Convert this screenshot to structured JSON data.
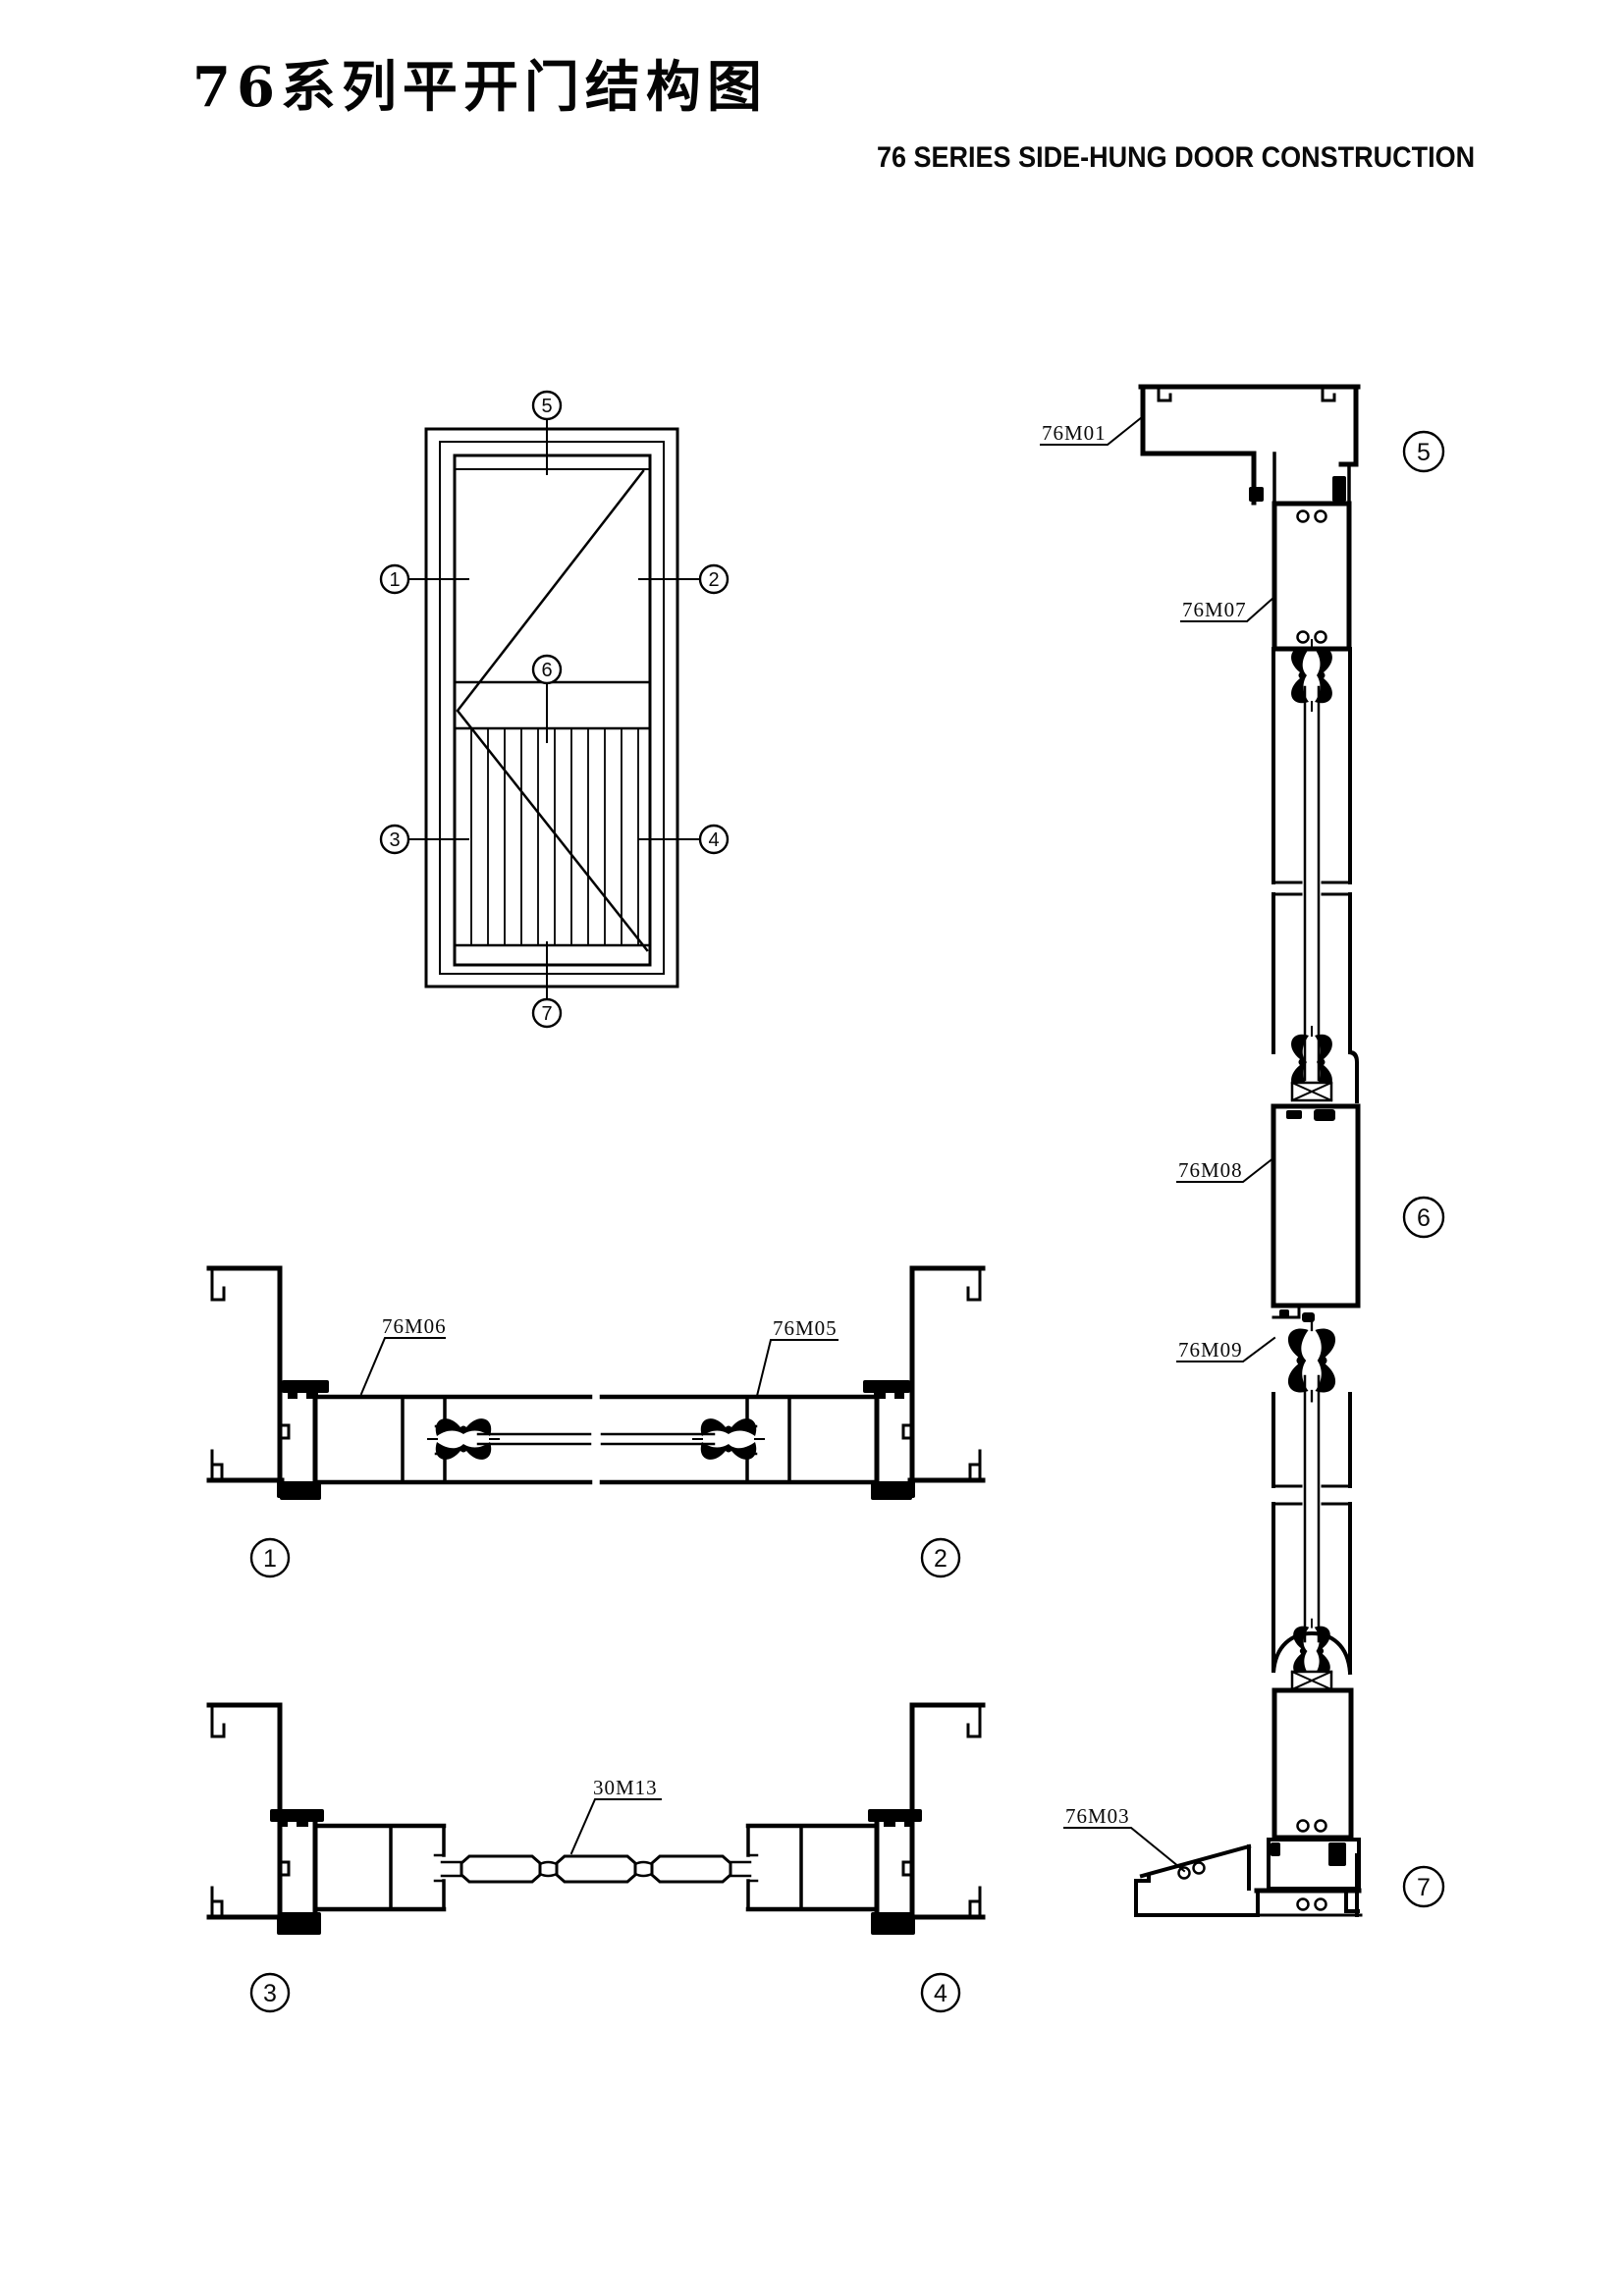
{
  "header": {
    "title_cn": "76系列平开门结构图",
    "title_en": "76 SERIES SIDE-HUNG DOOR CONSTRUCTION"
  },
  "part_labels": {
    "head_frame": "76M01",
    "top_rail": "76M07",
    "mid_rail": "76M08",
    "glazing_bead": "76M09",
    "threshold_ramp": "76M03",
    "hinge_jamb_stile": "76M06",
    "lock_stile": "76M05",
    "louver_slat": "30M13"
  },
  "section_markers": {
    "n1": "1",
    "n2": "2",
    "n3": "3",
    "n4": "4",
    "n5": "5",
    "n6": "6",
    "n7": "7"
  },
  "colors": {
    "line": "#000000",
    "background": "#ffffff"
  }
}
